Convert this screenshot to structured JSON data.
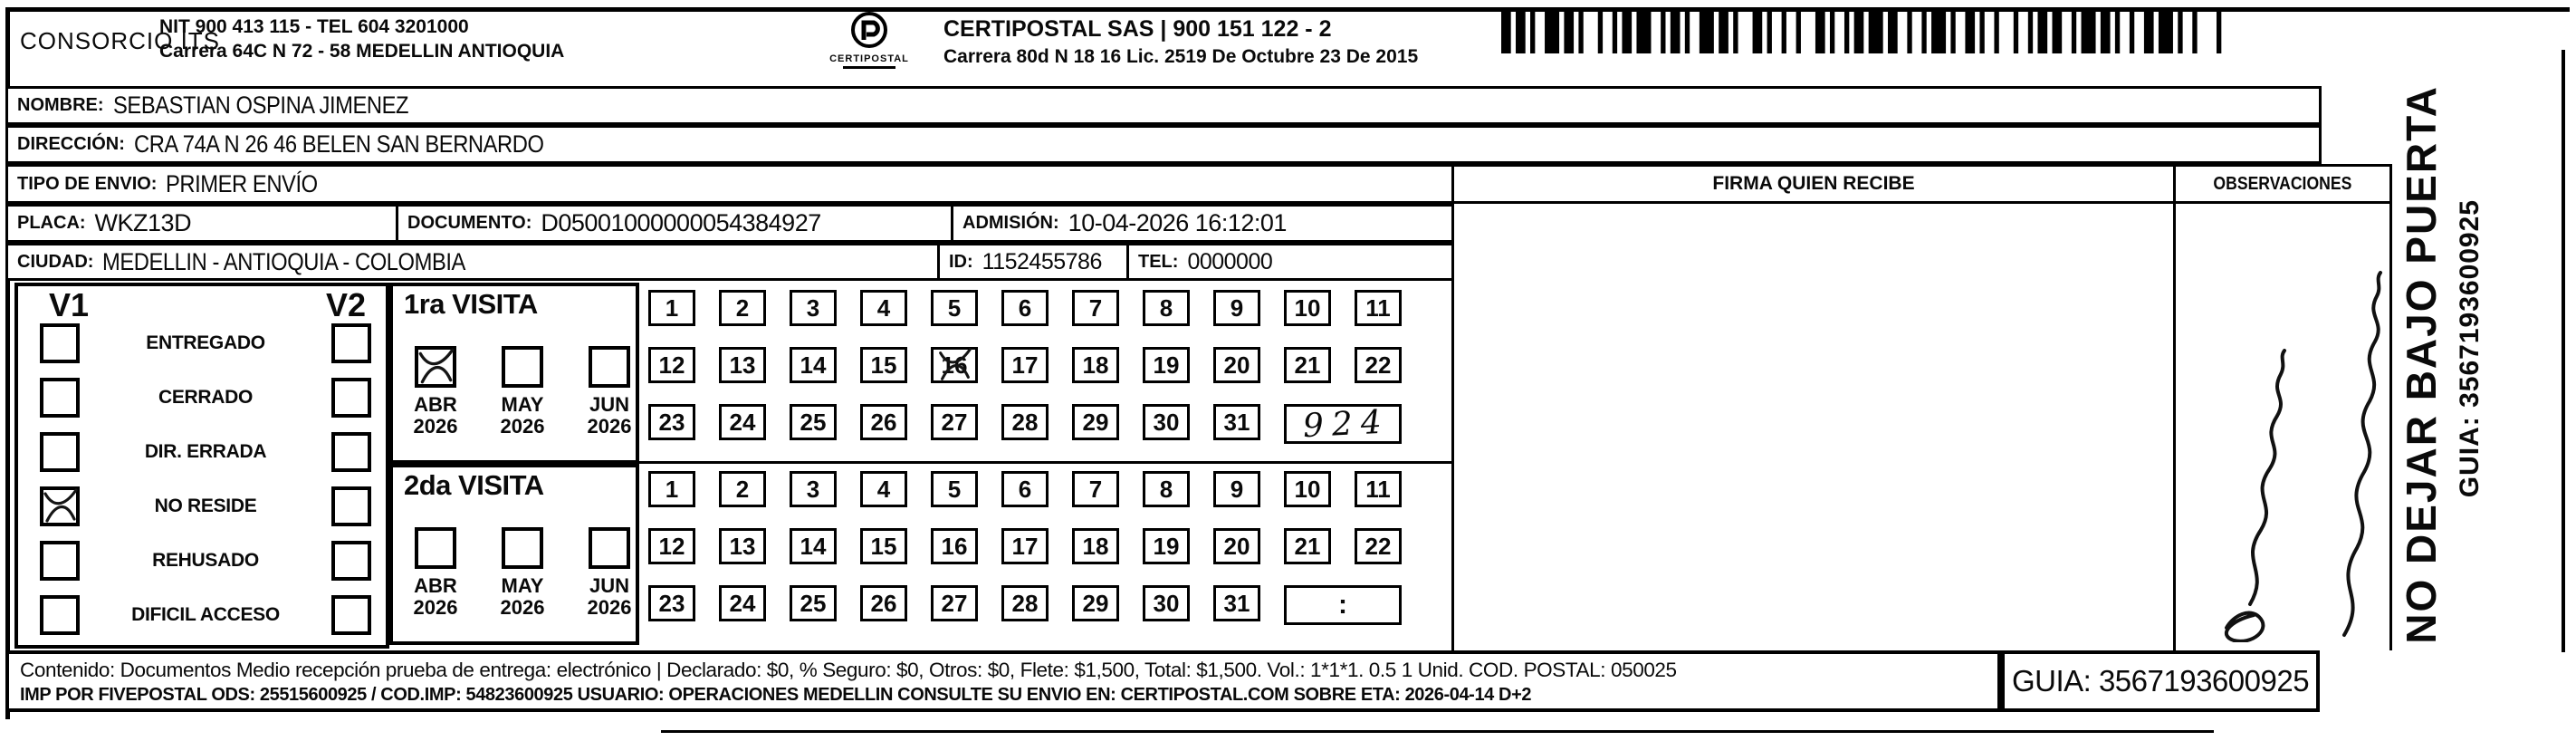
{
  "header": {
    "company": "CONSORCIO ITS",
    "company_nit_line": "NIT 900 413 115 - TEL 604 3201000",
    "company_address_line": "Carrera 64C N 72 - 58 MEDELLIN ANTIOQUIA",
    "logo_text": "CERTIPOSTAL",
    "operator_line": "CERTIPOSTAL SAS | 900 151 122 - 2",
    "operator_address_line": "Carrera 80d N 18 16  Lic. 2519 De Octubre 23 De 2015"
  },
  "shipment": {
    "nombre_label": "NOMBRE:",
    "nombre": "SEBASTIAN OSPINA JIMENEZ",
    "direccion_label": "DIRECCIÓN:",
    "direccion": "CRA 74A N 26 46 BELEN SAN BERNARDO",
    "tipo_envio_label": "TIPO DE ENVIO:",
    "tipo_envio": "PRIMER ENVÍO",
    "placa_label": "PLACA:",
    "placa": "WKZ13D",
    "documento_label": "DOCUMENTO:",
    "documento": "D05001000000054384927",
    "admision_label": "ADMISIÓN:",
    "admision": "10-04-2026 16:12:01",
    "ciudad_label": "CIUDAD:",
    "ciudad": "MEDELLIN - ANTIOQUIA - COLOMBIA",
    "id_label": "ID:",
    "id_value": "1152455786",
    "tel_label": "TEL:",
    "tel_value": "0000000"
  },
  "status_panel": {
    "col1_header": "V1",
    "col2_header": "V2",
    "options": [
      {
        "label": "ENTREGADO",
        "v1": false,
        "v2": false
      },
      {
        "label": "CERRADO",
        "v1": false,
        "v2": false
      },
      {
        "label": "DIR. ERRADA",
        "v1": false,
        "v2": false
      },
      {
        "label": "NO RESIDE",
        "v1": true,
        "v2": false
      },
      {
        "label": "REHUSADO",
        "v1": false,
        "v2": false
      },
      {
        "label": "DIFICIL ACCESO",
        "v1": false,
        "v2": false
      }
    ]
  },
  "visits": [
    {
      "title": "1ra VISITA",
      "months": [
        {
          "label": "ABR",
          "year": "2026",
          "checked": true
        },
        {
          "label": "MAY",
          "year": "2026",
          "checked": false
        },
        {
          "label": "JUN",
          "year": "2026",
          "checked": false
        }
      ],
      "day_rows": [
        [
          1,
          2,
          3,
          4,
          5,
          6,
          7,
          8,
          9,
          10,
          11
        ],
        [
          12,
          13,
          14,
          15,
          16,
          17,
          18,
          19,
          20,
          21,
          22
        ],
        [
          23,
          24,
          25,
          26,
          27,
          28,
          29,
          30,
          31
        ]
      ],
      "marked_day": 16,
      "extra_cell": "924",
      "extra_handwritten": true
    },
    {
      "title": "2da VISITA",
      "months": [
        {
          "label": "ABR",
          "year": "2026",
          "checked": false
        },
        {
          "label": "MAY",
          "year": "2026",
          "checked": false
        },
        {
          "label": "JUN",
          "year": "2026",
          "checked": false
        }
      ],
      "day_rows": [
        [
          1,
          2,
          3,
          4,
          5,
          6,
          7,
          8,
          9,
          10,
          11
        ],
        [
          12,
          13,
          14,
          15,
          16,
          17,
          18,
          19,
          20,
          21,
          22
        ],
        [
          23,
          24,
          25,
          26,
          27,
          28,
          29,
          30,
          31
        ]
      ],
      "marked_day": null,
      "extra_cell": ":",
      "extra_handwritten": false
    }
  ],
  "signature_section": {
    "header": "FIRMA QUIEN RECIBE"
  },
  "observations_section": {
    "header": "OBSERVACIONES"
  },
  "side_banner": {
    "warning": "NO DEJAR BAJO PUERTA",
    "guia": "GUIA: 3567193600925"
  },
  "footer": {
    "line1": "Contenido: Documentos Medio recepción prueba de entrega: electrónico | Declarado: $0, % Seguro: $0, Otros: $0, Flete: $1,500, Total: $1,500. Vol.: 1*1*1. 0.5  1 Unid. COD. POSTAL: 050025",
    "line2": "IMP POR FIVEPOSTAL ODS: 25515600925 / COD.IMP: 54823600925 USUARIO: OPERACIONES MEDELLIN CONSULTE SU ENVIO EN: CERTIPOSTAL.COM SOBRE ETA: 2026-04-14 D+2",
    "guia_box": "GUIA: 3567193600925"
  }
}
